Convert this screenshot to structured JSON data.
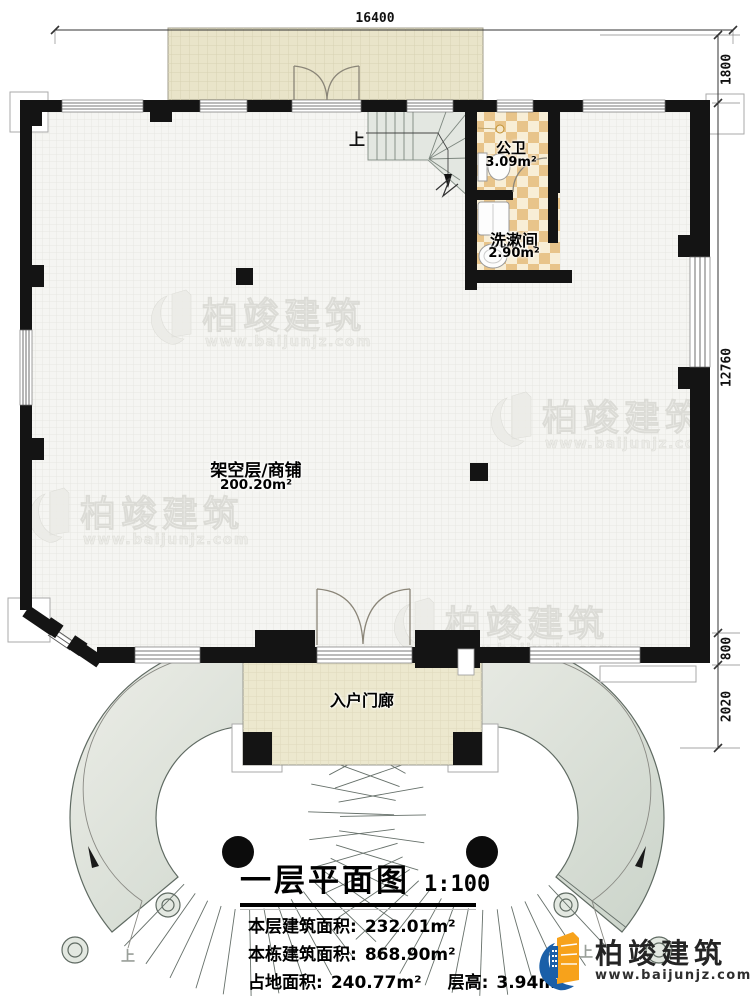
{
  "dims": {
    "top": "16400",
    "r1": "1800",
    "r2": "12760",
    "r3": "800",
    "r4": "2020"
  },
  "rooms": {
    "toilet_name": "公卫",
    "toilet_area": "3.09m²",
    "wash_name": "洗漱间",
    "wash_area": "2.90m²",
    "shop_name": "架空层/商铺",
    "shop_area": "200.20m²",
    "porch_name": "入户门廊",
    "up_interior": "上",
    "up_left": "上",
    "up_right": "上"
  },
  "title_block": {
    "title": "一层平面图",
    "scale": "1:100",
    "floor_area_label": "本层建筑面积:",
    "floor_area_value": "232.01m²",
    "building_area_label": "本栋建筑面积:",
    "building_area_value": "868.90m²",
    "land_area_label": "占地面积:",
    "land_area_value": "240.77m²",
    "height_label": "层高:",
    "height_value": "3.94m"
  },
  "wm": {
    "brand": "柏竣建筑",
    "url": "www.baijunjz.com"
  },
  "logo": {
    "brand": "柏竣建筑",
    "url": "www.baijunjz.com"
  },
  "colors": {
    "wall": "#141414",
    "terrace_floor": "#e9e4c9",
    "porch_floor": "#ece8ce",
    "bath_tile_dark": "#e8c48a",
    "bath_tile_light": "#f8eed6",
    "stair_tread": "#dfe4dc",
    "logo_blue": "#1a5fa8",
    "logo_orange": "#f7a21b"
  }
}
